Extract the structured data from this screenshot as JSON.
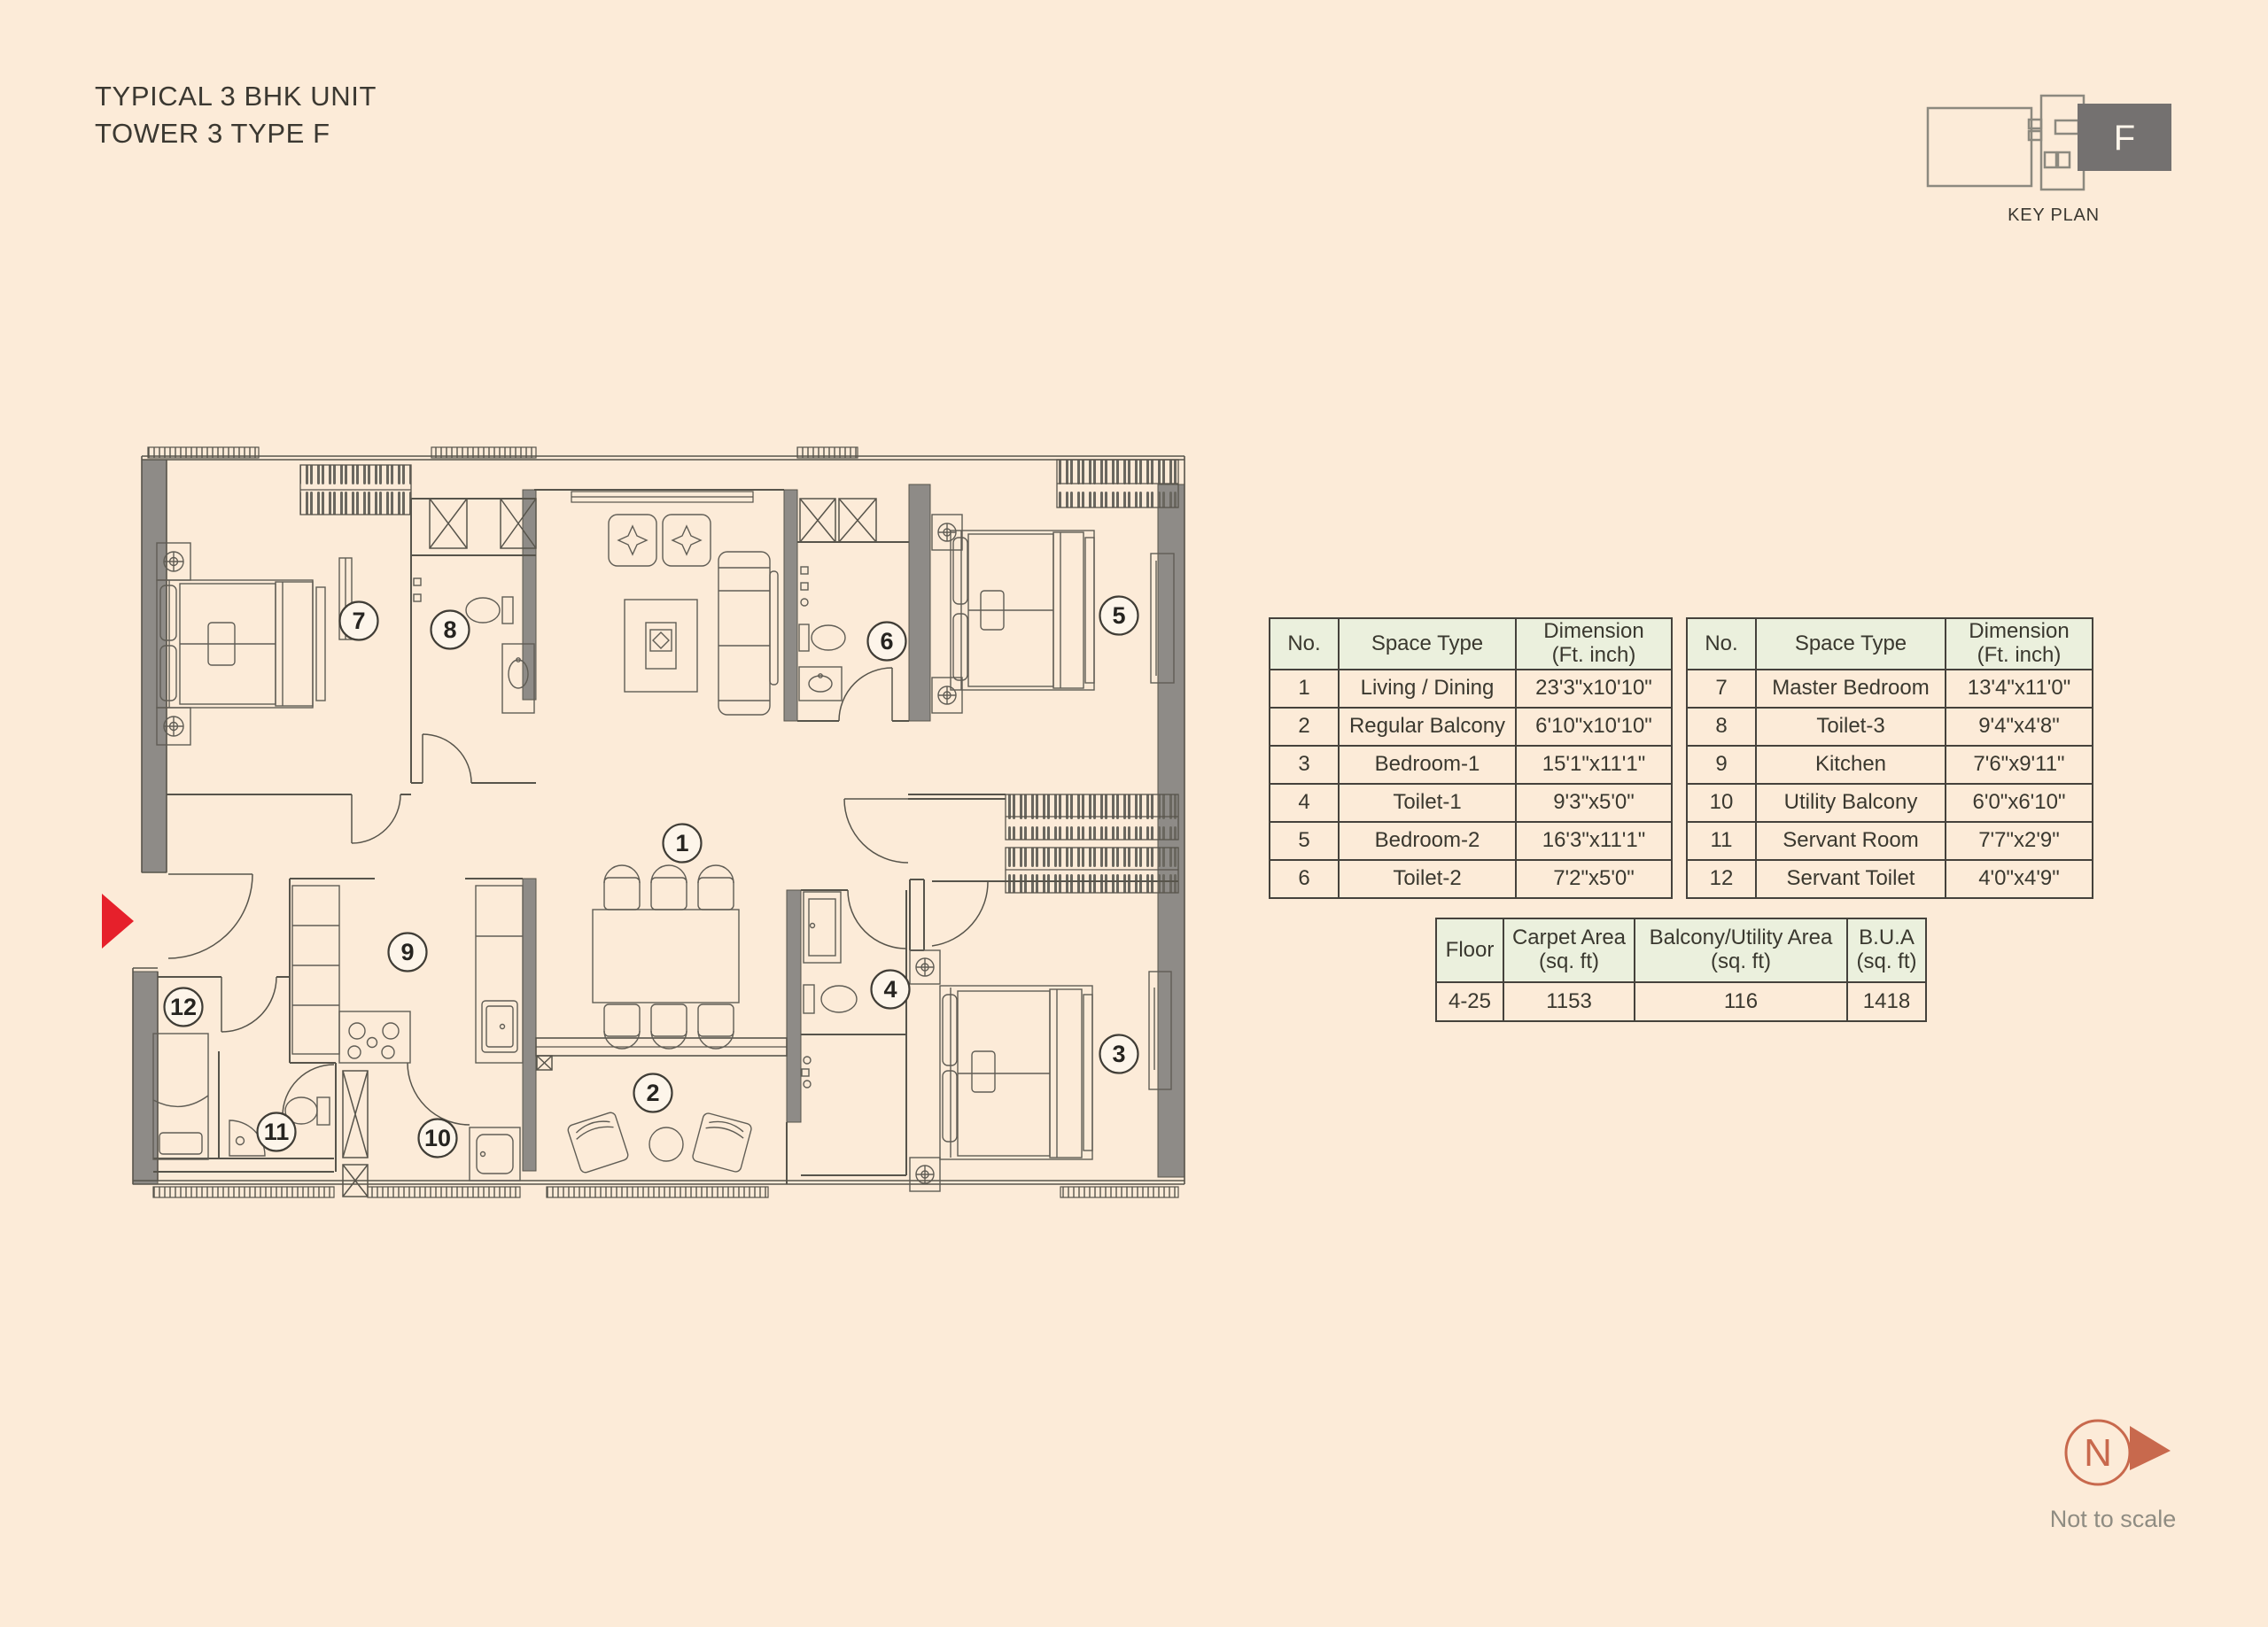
{
  "title": {
    "line1": "TYPICAL 3 BHK UNIT",
    "line2": "TOWER 3 TYPE F"
  },
  "key_plan": {
    "caption": "KEY PLAN",
    "unit_label": "F"
  },
  "north": {
    "label": "N",
    "note": "Not to scale"
  },
  "colors": {
    "background": "#fcebd8",
    "plan_line": "#57544b",
    "wall_fill": "#8e8b87",
    "table_header": "#ebf0dd",
    "table_border": "#45423c",
    "entry_arrow": "#e6202b",
    "north_symbol": "#c8694d",
    "keyplan_unit_fill": "#747170"
  },
  "space_tables": [
    {
      "headers": {
        "no": "No.",
        "space": "Space Type",
        "dim_1": "Dimension",
        "dim_2": "(Ft. inch)"
      },
      "rows": [
        {
          "no": "1",
          "space": "Living / Dining",
          "dim": "23'3\"x10'10\""
        },
        {
          "no": "2",
          "space": "Regular Balcony",
          "dim": "6'10\"x10'10\""
        },
        {
          "no": "3",
          "space": "Bedroom-1",
          "dim": "15'1\"x11'1\""
        },
        {
          "no": "4",
          "space": "Toilet-1",
          "dim": "9'3\"x5'0\""
        },
        {
          "no": "5",
          "space": "Bedroom-2",
          "dim": "16'3\"x11'1\""
        },
        {
          "no": "6",
          "space": "Toilet-2",
          "dim": "7'2\"x5'0\""
        }
      ]
    },
    {
      "headers": {
        "no": "No.",
        "space": "Space Type",
        "dim_1": "Dimension",
        "dim_2": "(Ft. inch)"
      },
      "rows": [
        {
          "no": "7",
          "space": "Master Bedroom",
          "dim": "13'4\"x11'0\""
        },
        {
          "no": "8",
          "space": "Toilet-3",
          "dim": "9'4\"x4'8\""
        },
        {
          "no": "9",
          "space": "Kitchen",
          "dim": "7'6\"x9'11\""
        },
        {
          "no": "10",
          "space": "Utility Balcony",
          "dim": "6'0\"x6'10\""
        },
        {
          "no": "11",
          "space": "Servant Room",
          "dim": "7'7\"x2'9\""
        },
        {
          "no": "12",
          "space": "Servant Toilet",
          "dim": "4'0\"x4'9\""
        }
      ]
    }
  ],
  "area_table": {
    "headers": {
      "floor": "Floor",
      "carpet_1": "Carpet Area",
      "carpet_2": "(sq. ft)",
      "balcony_1": "Balcony/Utility Area",
      "balcony_2": "(sq. ft)",
      "bua_1": "B.U.A",
      "bua_2": "(sq. ft)"
    },
    "row": {
      "floor": "4-25",
      "carpet": "1153",
      "balcony": "116",
      "bua": "1418"
    }
  },
  "plan": {
    "markers": [
      "1",
      "2",
      "3",
      "4",
      "5",
      "6",
      "7",
      "8",
      "9",
      "10",
      "11",
      "12"
    ]
  }
}
